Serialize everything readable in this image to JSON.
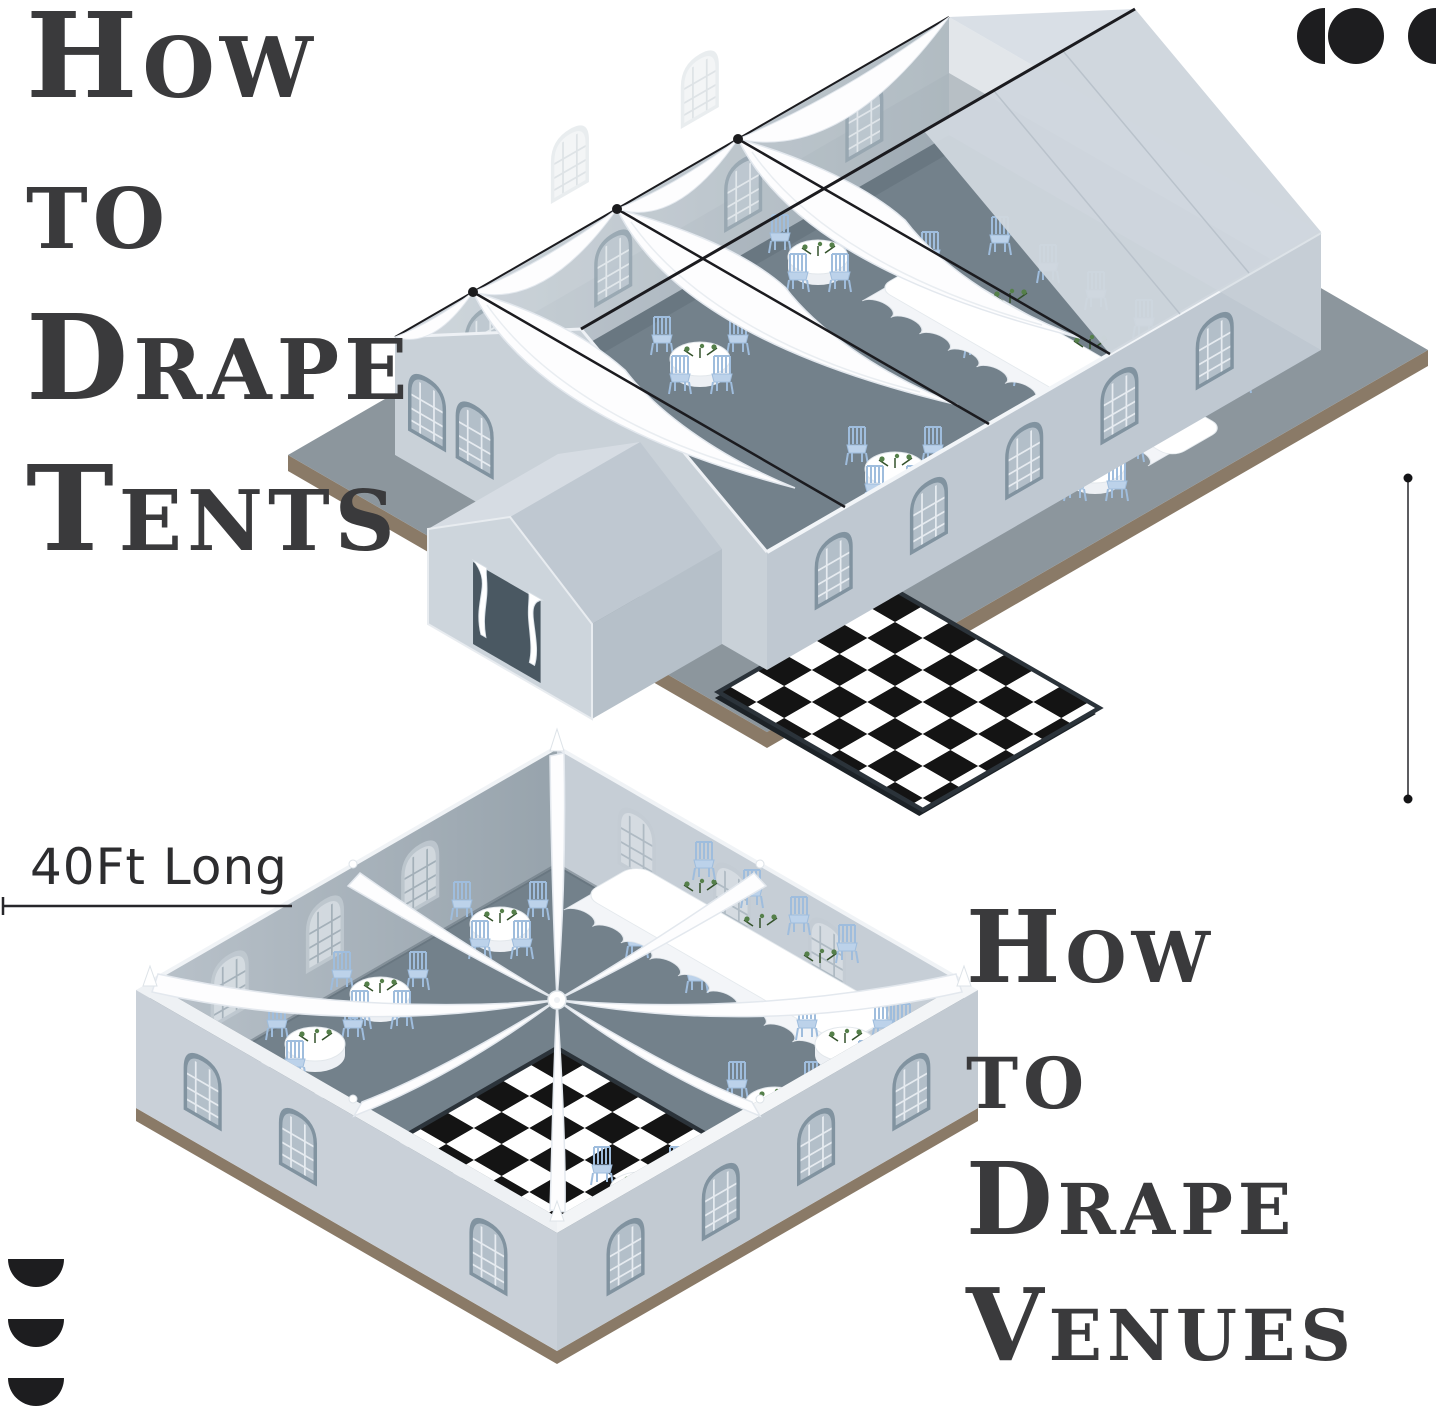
{
  "page": {
    "background": "#ffffff"
  },
  "titles": {
    "top": {
      "line1": "How",
      "line2": "to",
      "line3": "Drape",
      "line4": "Tents"
    },
    "bottom": {
      "line1": "How",
      "line2": "to",
      "line3": "Drape",
      "line4": "Venues"
    }
  },
  "labels": {
    "length": "40Ft Long"
  },
  "icons": {
    "top_right": "half-disc-circle-half-disc-icon",
    "bottom_left": "three-stacked-half-discs-icon"
  },
  "colors": {
    "title_text": "#3a3a3c",
    "label_text": "#2d2d2f",
    "icon_black": "#1d1d1f",
    "platform_gray": "#8c969d",
    "base_brown": "#8a7a67",
    "floor_slate": "#73818b",
    "wall_light": "#c5cdd5",
    "wall_inner_dark": "#5d6b75",
    "roof_light": "#ced5dd",
    "drape_white": "#fdfdfe",
    "chair_blue": "#bcd2ea",
    "checker_black": "#141414",
    "checker_white": "#ffffff",
    "greenery_green": "#55804a"
  }
}
